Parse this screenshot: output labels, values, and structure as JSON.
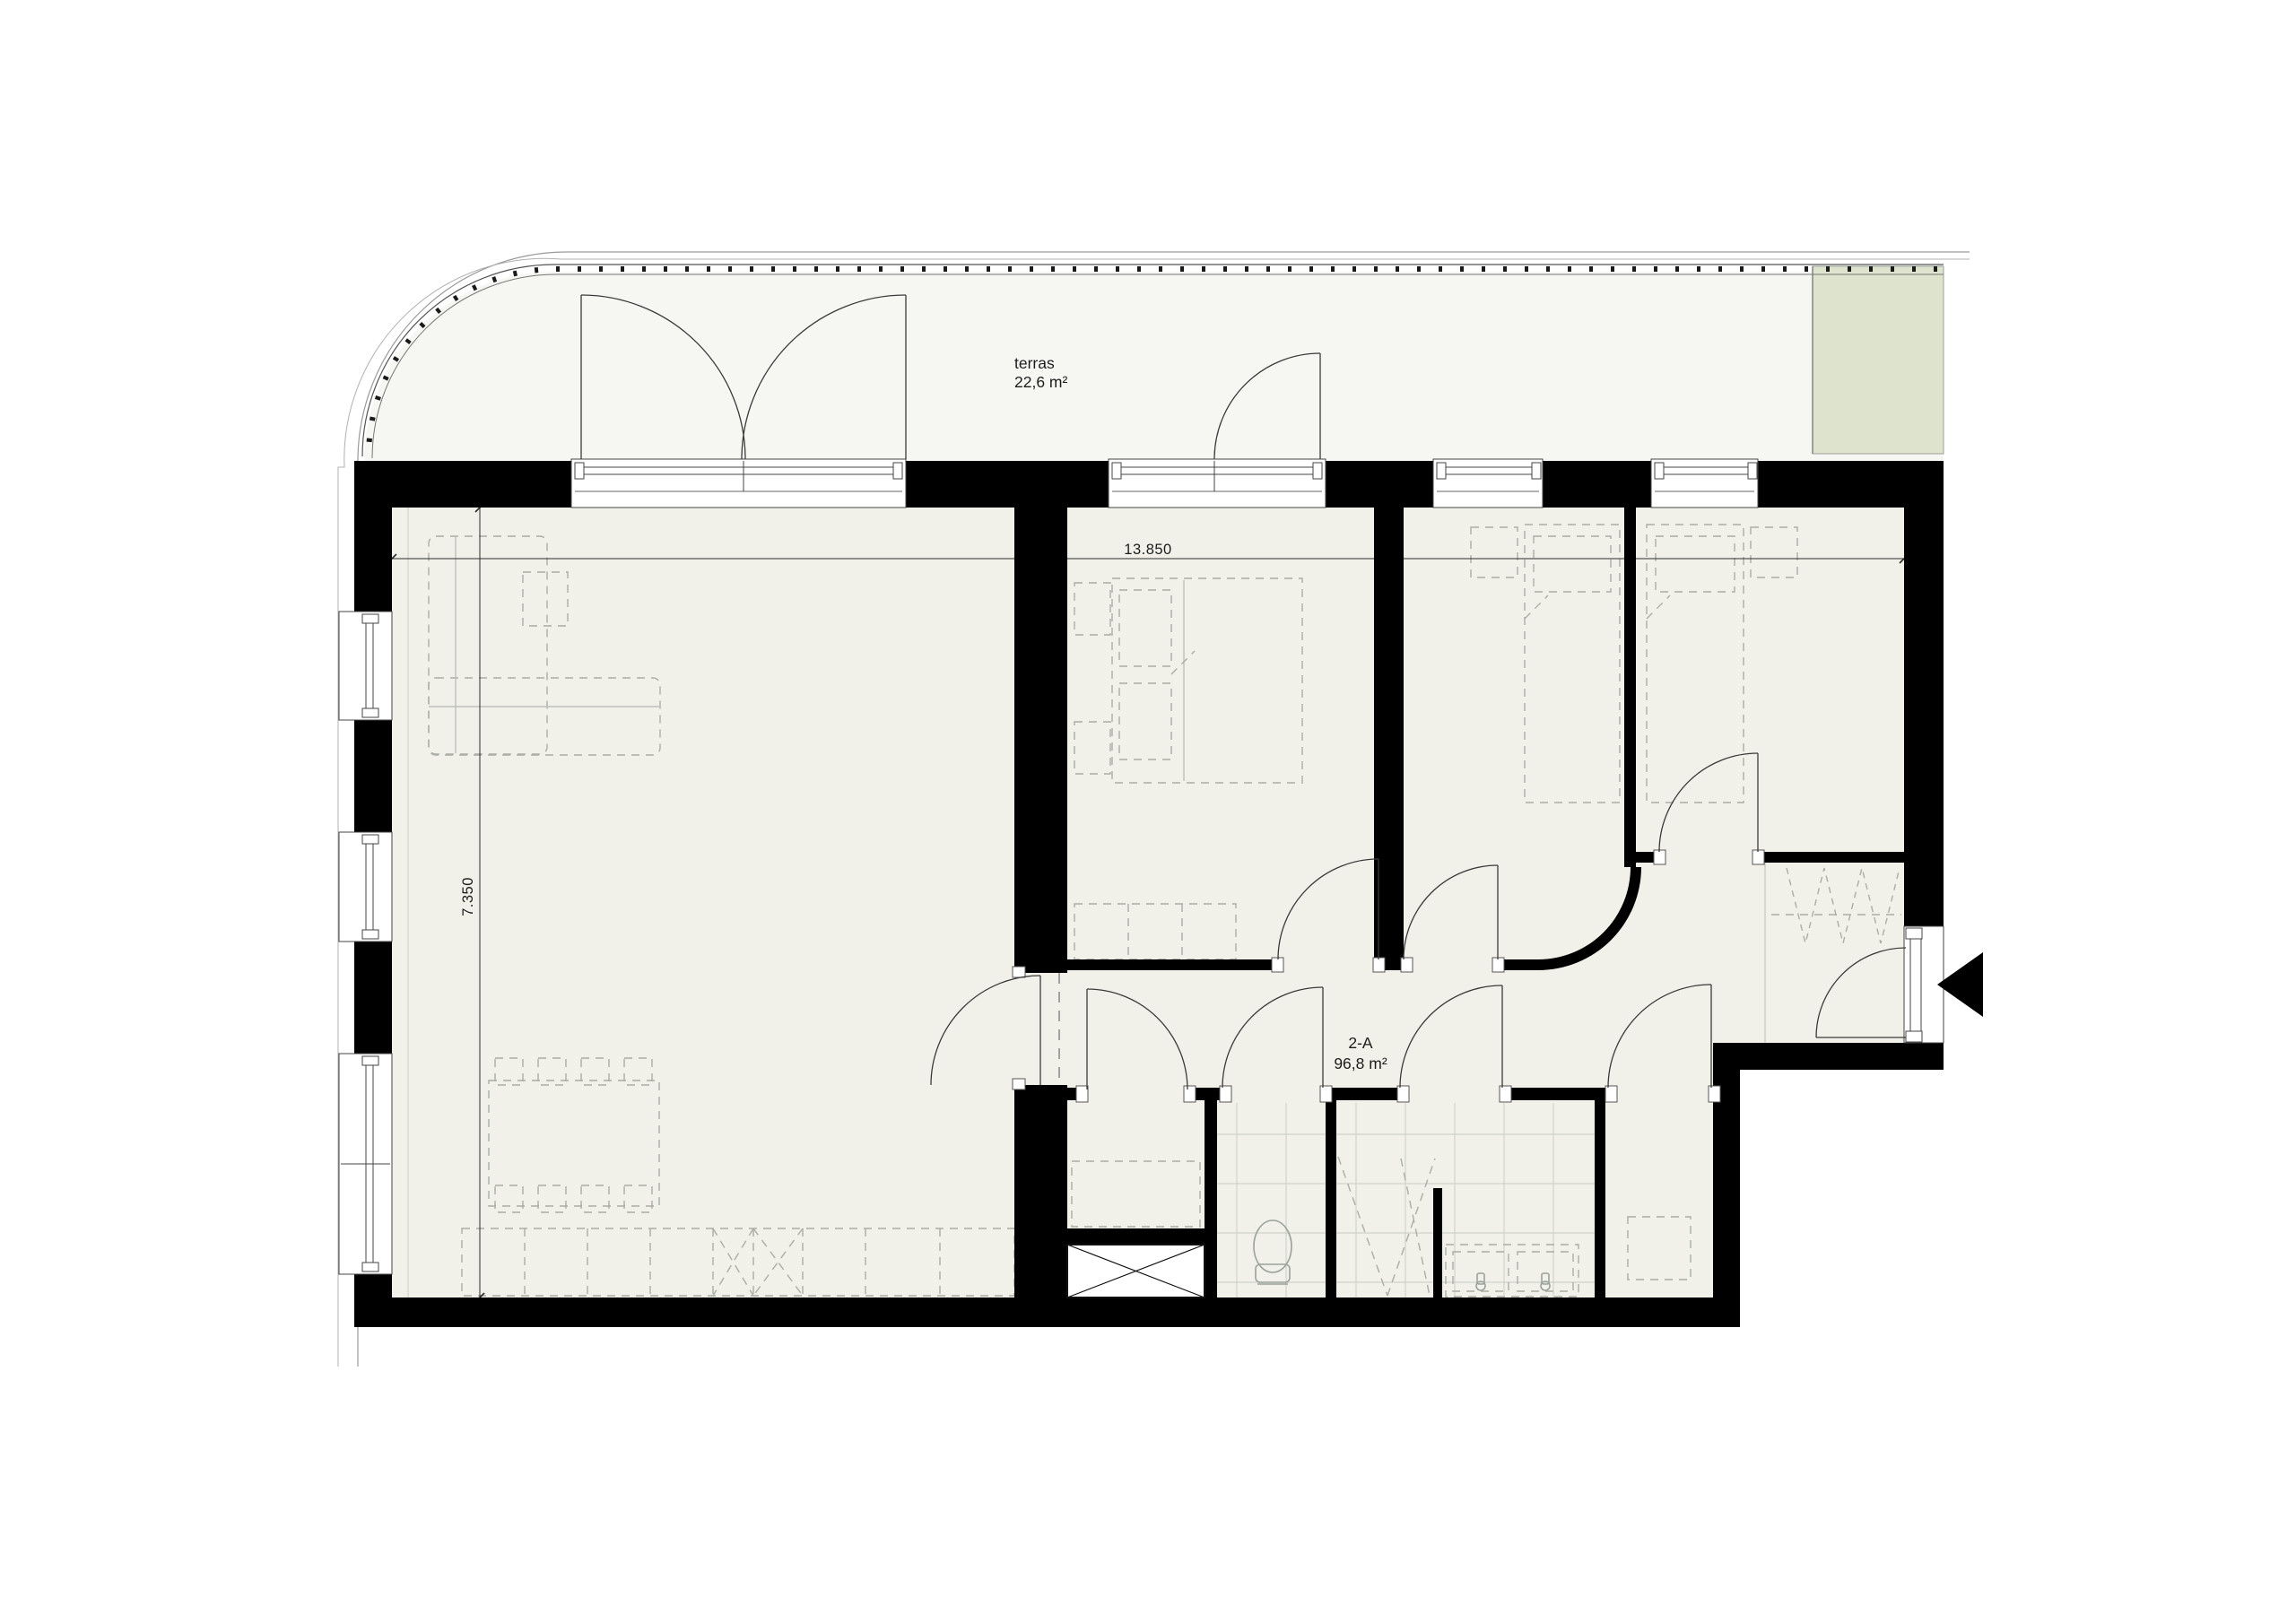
{
  "plan": {
    "terrace": {
      "label": "terras",
      "area": "22,6 m²"
    },
    "apartment": {
      "unit": "2-A",
      "area": "96,8 m²"
    },
    "dimensions": {
      "horizontal": "13.850",
      "vertical": "7.350"
    },
    "colors": {
      "wall": "#000000",
      "floor": "#f2f1e9",
      "terrace_floor": "#f6f6f3",
      "planter": "#dde3cd",
      "tile_line": "#c6cbc2",
      "furniture_line": "#a9aea6",
      "door_line": "#3a3a3a"
    },
    "icons": {
      "entrance_arrow": "entrance-direction-arrow"
    }
  }
}
